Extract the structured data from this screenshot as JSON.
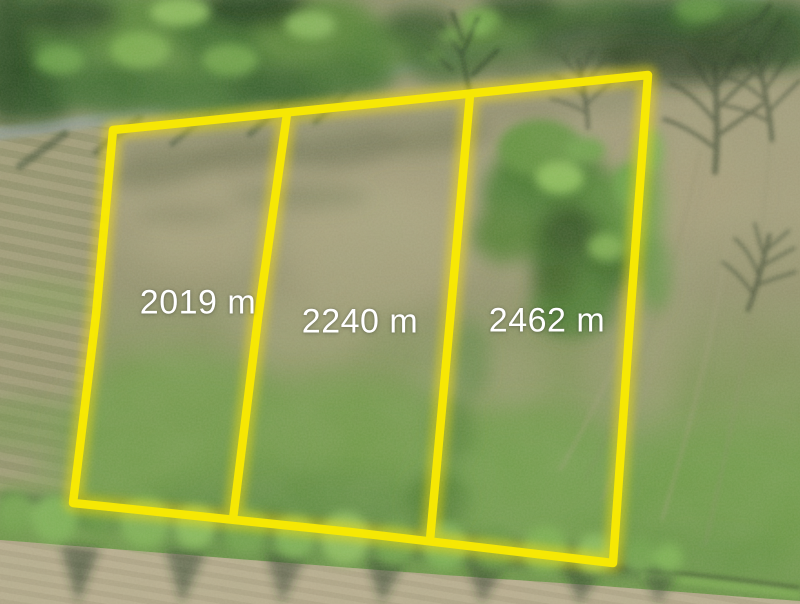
{
  "photo": {
    "kind": "aerial-drone-photo-of-land-parcels",
    "colors": {
      "boundary_yellow": "#f8e903",
      "label_text": "#ffffff"
    },
    "parcels": [
      {
        "name": "parcel-1",
        "area_label": "2019 m"
      },
      {
        "name": "parcel-2",
        "area_label": "2240 m"
      },
      {
        "name": "parcel-3",
        "area_label": "2462 m"
      }
    ]
  }
}
